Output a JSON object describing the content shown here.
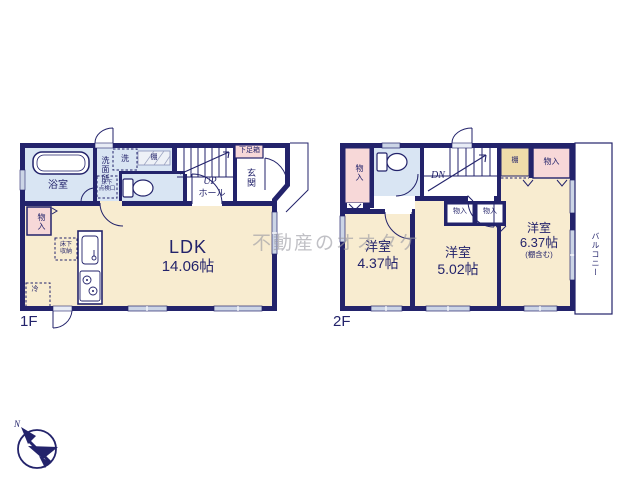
{
  "watermark": "不動産のオオタケ",
  "compass_n": "N",
  "colors": {
    "wall": "#23236b",
    "room_cream": "#f8ecd0",
    "wet_blue": "#d9e5f3",
    "closet_pink": "#f7d8d8",
    "shelf_tan": "#efdcaa",
    "window_gray": "#ccd5e6",
    "watermark_gray": "#9b9ba3"
  },
  "floor1": {
    "label": "1F",
    "ldk_name": "LDK",
    "ldk_size": "14.06帖",
    "bath": "浴室",
    "washroom": "洗面所",
    "washer": "洗",
    "shelf": "棚",
    "hatch1": "床下",
    "hatch2": "点検口",
    "storage1": "床下",
    "storage2": "収納",
    "closet": "物入",
    "fridge": "冷",
    "shoe_cabinet": "下足箱",
    "entrance": "玄関",
    "up": "UP",
    "hall": "ホール"
  },
  "floor2": {
    "label": "2F",
    "dn": "DN",
    "closet_top_left": "物入",
    "shelf": "棚",
    "closet_top_right": "物入",
    "closet_mid_left": "物入",
    "closet_mid_right": "物入",
    "room_a_name": "洋室",
    "room_a_size": "4.37帖",
    "room_b_name": "洋室",
    "room_b_size": "5.02帖",
    "room_c_name": "洋室",
    "room_c_size": "6.37帖",
    "room_c_note": "(棚含む)",
    "balcony": "バルコニー"
  }
}
